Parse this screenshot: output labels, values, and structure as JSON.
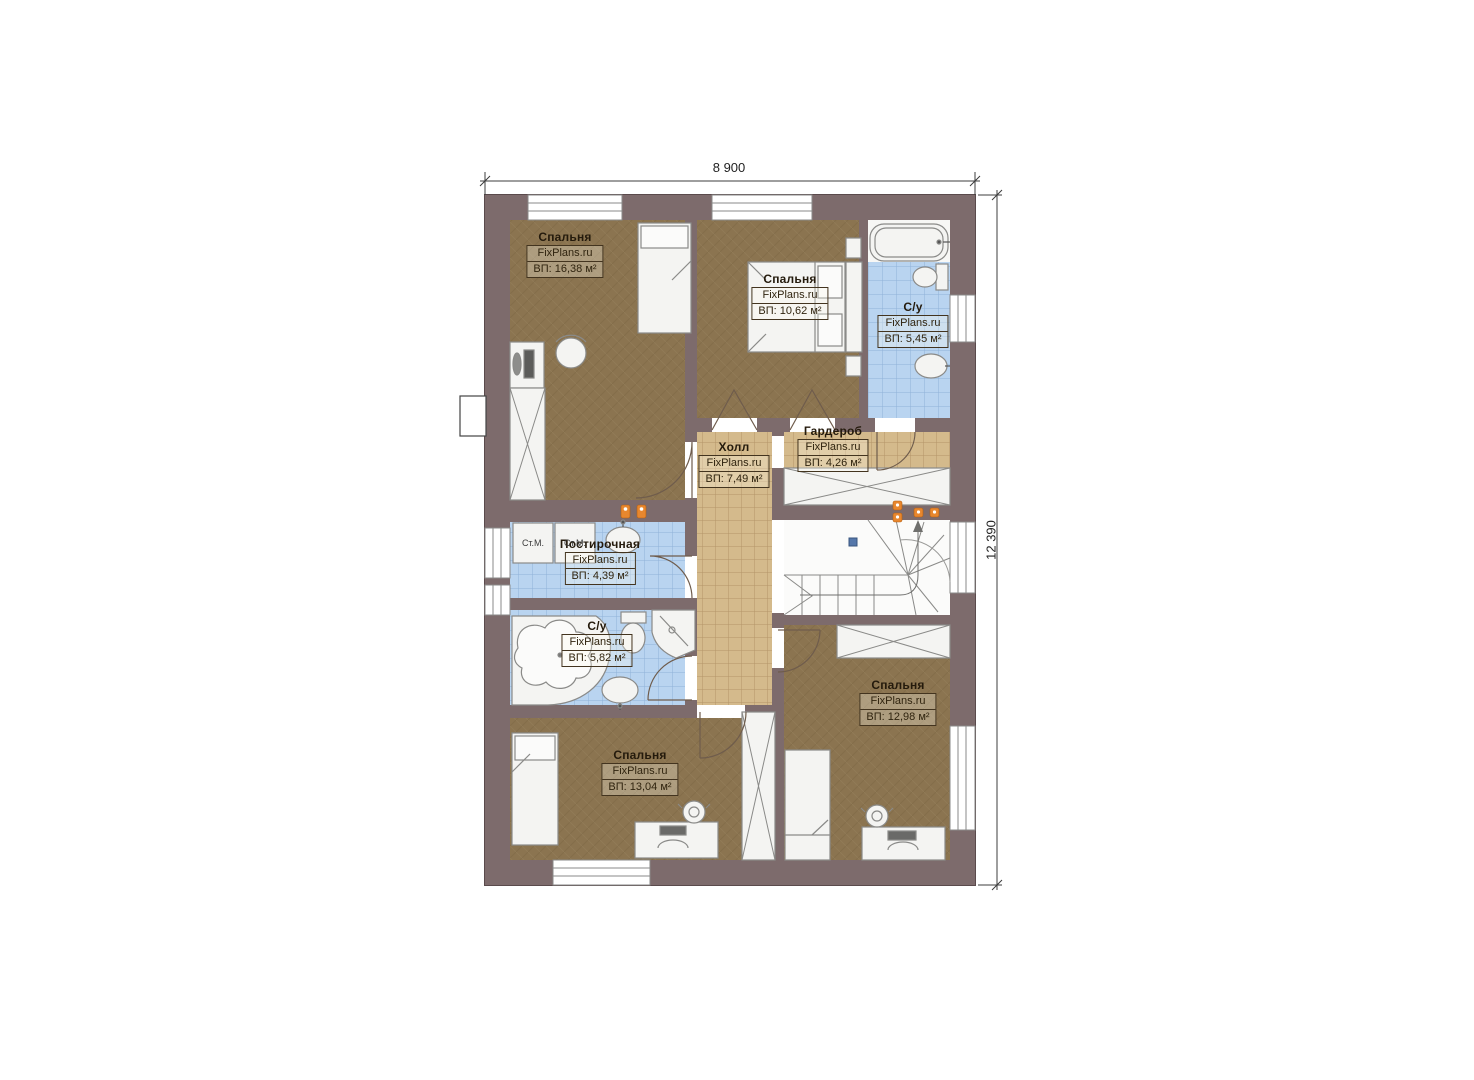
{
  "watermark": "FixPlans.ru",
  "dimensions": {
    "width_label": "8 900",
    "height_label": "12 390"
  },
  "rooms": [
    {
      "name": "Спальня",
      "area_label": "ВП: 16,38 м²"
    },
    {
      "name": "Спальня",
      "area_label": "ВП: 10,62 м²"
    },
    {
      "name": "С/у",
      "area_label": "ВП: 5,45 м²"
    },
    {
      "name": "Холл",
      "area_label": "ВП: 7,49 м²"
    },
    {
      "name": "Гардероб",
      "area_label": "ВП: 4,26 м²"
    },
    {
      "name": "Постирочная",
      "area_label": "ВП: 4,39 м²"
    },
    {
      "name": "С/у",
      "area_label": "ВП: 5,82 м²"
    },
    {
      "name": "Спальня",
      "area_label": "ВП: 13,04 м²"
    },
    {
      "name": "Спальня",
      "area_label": "ВП: 12,98 м²"
    }
  ],
  "laundry": {
    "washer_label": "Ст.М."
  },
  "colors": {
    "wall": "#7d6b6c",
    "wood_floor": "#8b7450",
    "tile_beige": "#d4ba8c",
    "tile_blue": "#b9d4f0",
    "lamp_orange": "#e8872e"
  }
}
